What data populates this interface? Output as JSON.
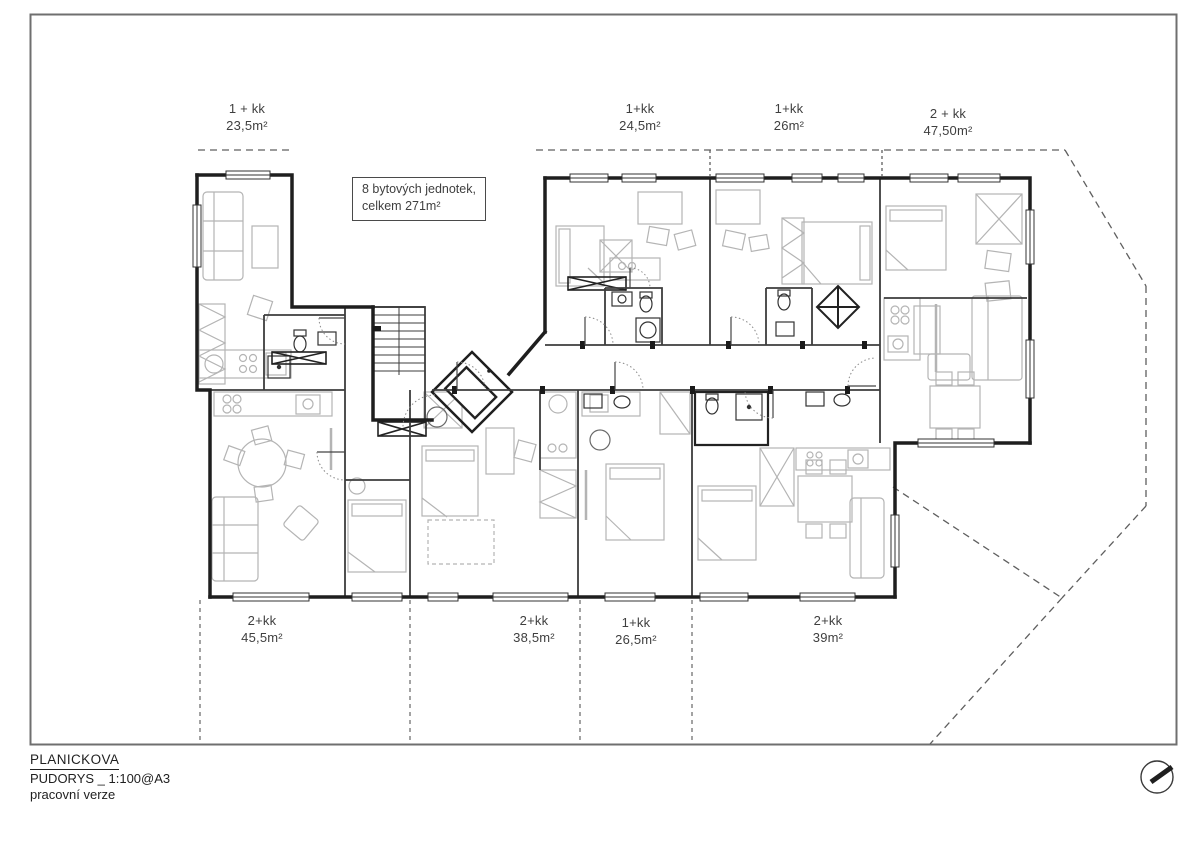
{
  "annotation_box": {
    "line1": "8 bytových jednotek,",
    "line2": "celkem 271m²"
  },
  "unit_labels_top": [
    {
      "type": "1 + kk",
      "area": "23,5m²"
    },
    {
      "type": "1+kk",
      "area": "24,5m²"
    },
    {
      "type": "1+kk",
      "area": "26m²"
    },
    {
      "type": "2 + kk",
      "area": "47,50m²"
    }
  ],
  "unit_labels_bottom": [
    {
      "type": "2+kk",
      "area": "45,5m²"
    },
    {
      "type": "2+kk",
      "area": "38,5m²"
    },
    {
      "type": "1+kk",
      "area": "26,5m²"
    },
    {
      "type": "2+kk",
      "area": "39m²"
    }
  ],
  "title_block": {
    "project": "PLANICKOVA",
    "drawing": "PUDORYS _ 1:100@A3",
    "status": "pracovní verze"
  },
  "icons": {
    "north_arrow": "north-arrow"
  },
  "colors": {
    "wall": "#1e1e1e",
    "partition": "#3d3d3d",
    "furniture": "#b4b4b4",
    "lot_line": "#5f5f5f",
    "sheet_border": "#6f6f6f",
    "text": "#3f3f3f"
  }
}
